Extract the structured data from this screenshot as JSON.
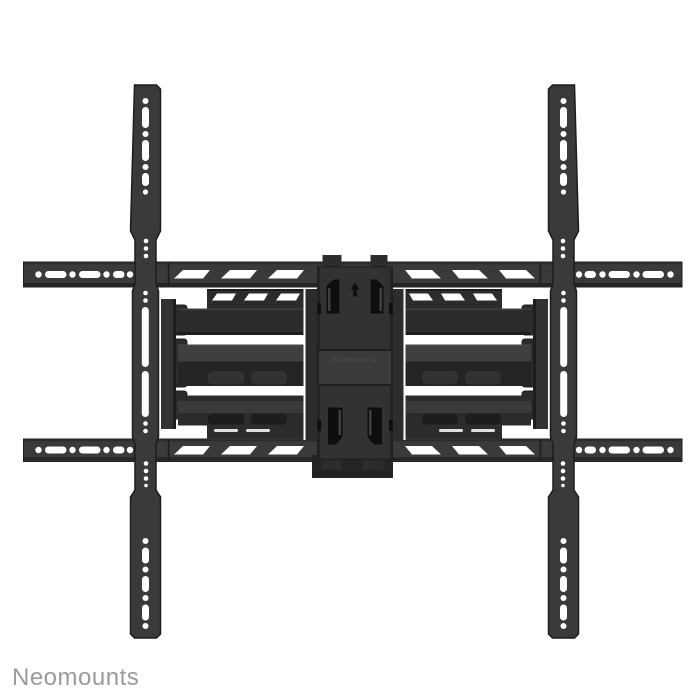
{
  "watermark": {
    "text": "Neomounts"
  },
  "product": {
    "embossed_label": "Neomounts"
  },
  "colors": {
    "bg": "#ffffff",
    "metal-face": "#3a3a3a",
    "metal-mid": "#323232",
    "metal-dark": "#2c2c2c",
    "metal-darker": "#242424",
    "metal-deep": "#1d1d1d",
    "metal-light": "#3f3f3f",
    "metal-light2": "#474747",
    "cutout": "#0e0e0e",
    "hole": "#ffffff",
    "emboss": "#4a4a4a",
    "watermark": "#9b9b9b"
  }
}
